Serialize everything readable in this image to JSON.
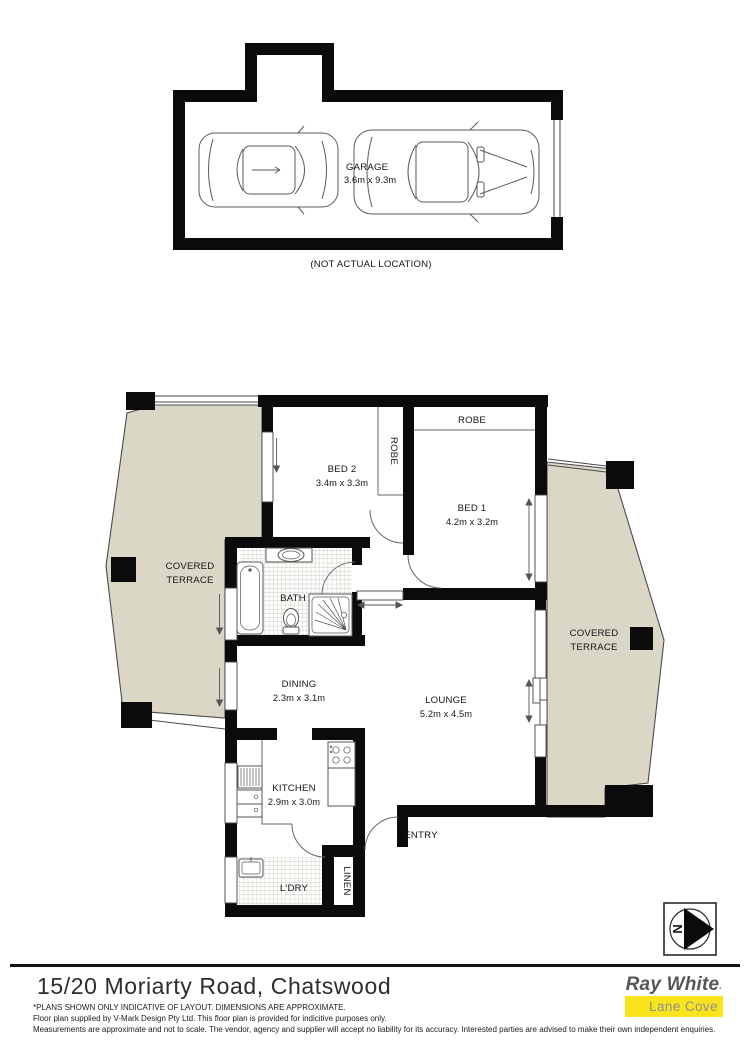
{
  "plan": {
    "garage": {
      "label": "GARAGE",
      "dims": "3.6m x 9.3m",
      "note": "(NOT ACTUAL LOCATION)"
    },
    "bed2": {
      "label": "BED 2",
      "dims": "3.4m x 3.3m",
      "robe": "ROBE"
    },
    "bed1": {
      "label": "BED 1",
      "dims": "4.2m x 3.2m",
      "robe": "ROBE"
    },
    "bath": {
      "label": "BATH"
    },
    "dining": {
      "label": "DINING",
      "dims": "2.3m x 3.1m"
    },
    "lounge": {
      "label": "LOUNGE",
      "dims": "5.2m x 4.5m"
    },
    "kitchen": {
      "label": "KITCHEN",
      "dims": "2.9m x 3.0m"
    },
    "entry": {
      "label": "ENTRY"
    },
    "ldry": {
      "label": "L'DRY"
    },
    "linen": {
      "label": "LINEN"
    },
    "terrace_left": {
      "line1": "COVERED",
      "line2": "TERRACE"
    },
    "terrace_right": {
      "line1": "COVERED",
      "line2": "TERRACE"
    }
  },
  "compass": {
    "letter": "N"
  },
  "footer": {
    "address": "15/20 Moriarty Road, Chatswood",
    "disclaimer_lines": [
      "*PLANS SHOWN ONLY INDICATIVE OF LAYOUT. DIMENSIONS ARE APPROXIMATE.",
      "Floor plan supplied by V-Mark Design Pty Ltd. This floor plan is provided for indicitive purposes only.",
      "Measurements are approximate and not to scale. The vendor, agency and supplier will accept no liability for its accuracy. Interested parties are advised to make their own independent enquiries."
    ]
  },
  "brand": {
    "name": "Ray White",
    "mark": ".",
    "office": "Lane Cove"
  },
  "colors": {
    "wall": "#0b0b0b",
    "terrace_fill": "#DBD7C6",
    "thin_line": "#4a4a4a",
    "brand_gray": "#55565A",
    "office_yellow": "#F9E31C",
    "office_text": "#8F9194"
  }
}
